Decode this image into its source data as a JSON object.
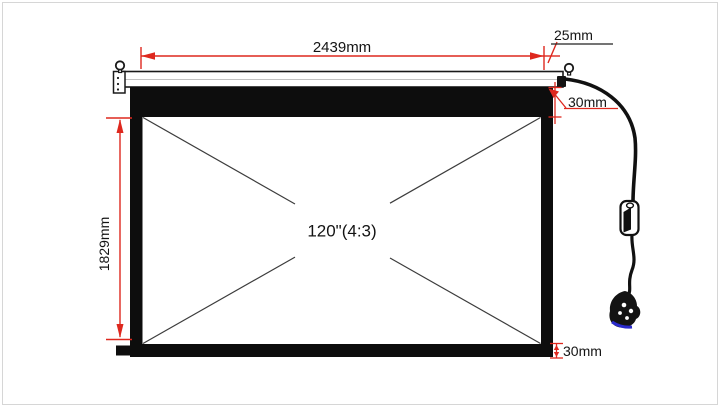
{
  "labels": {
    "dim_width": "2439mm",
    "dim_housing_offset": "25mm",
    "dim_top_border": "30mm",
    "dim_height": "1829mm",
    "dim_bottom_border": "30mm",
    "screen_size": "120\"(4:3)"
  },
  "colors": {
    "dimension_red": "#de281e",
    "screen_black": "#0d0d0d",
    "diagonal_gray": "#3c3c3c",
    "plug_tip_blue": "#2a2acc"
  }
}
